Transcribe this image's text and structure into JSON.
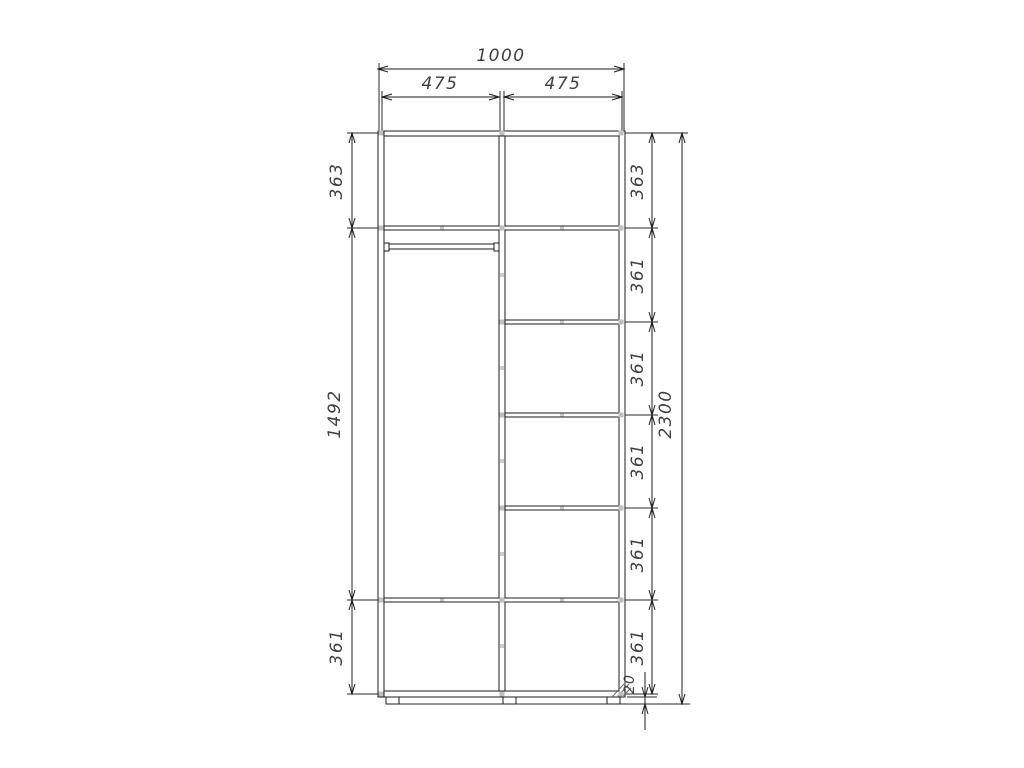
{
  "drawing": {
    "colors": {
      "line": "#1c1c1c",
      "text": "#404040",
      "fitting": "#bfbfbf"
    },
    "dimensions": {
      "overall_width": "1000",
      "left_section_width": "475",
      "right_section_width": "475",
      "overall_height": "2300",
      "left_column_cells": [
        "363",
        "1492",
        "361"
      ],
      "right_column_cells": [
        "363",
        "361",
        "361",
        "361",
        "361",
        "361"
      ],
      "base_height": "20"
    }
  }
}
